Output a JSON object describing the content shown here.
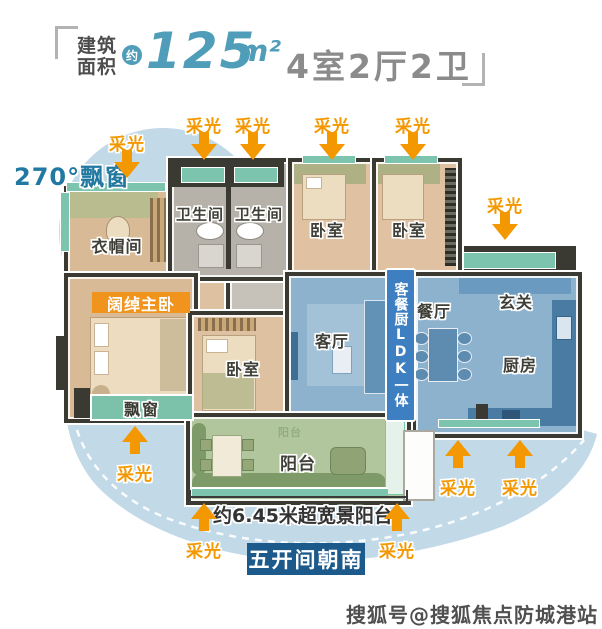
{
  "header": {
    "area_label_line1": "建筑",
    "area_label_line2": "面积",
    "approx": "约",
    "area_value": "125",
    "area_unit": "m²",
    "rooms_summary": "4室2厅2卫"
  },
  "plan": {
    "rooms": {
      "cloakroom": "衣帽间",
      "bathroom": "卫生间",
      "bedroom": "卧室",
      "living_room": "客厅",
      "dining_room": "餐厅",
      "foyer": "玄关",
      "kitchen": "厨房",
      "balcony": "阳台"
    },
    "badges": {
      "master_bedroom": "阔绰主卧",
      "bay_window": "飘窗",
      "ldk": "客餐厨LDK一体",
      "south_facing": "五开间朝南"
    },
    "annotations": {
      "daylight": "采光",
      "bay_window_270": "270°飘窗",
      "balcony_width": "约6.45米超宽景阳台"
    }
  },
  "watermark": "搜狐号@搜狐焦点防城港站",
  "colors": {
    "accent_orange": "#f39800",
    "accent_teal": "#4f9db8",
    "light_blue": "#c2d9e8",
    "window_teal": "#7cc4ae",
    "ldk_badge_blue": "#3d7fc0",
    "south_badge_navy": "#1d5a8c",
    "master_badge_orange": "#f0941d",
    "wall_dark": "#3a3a33"
  }
}
